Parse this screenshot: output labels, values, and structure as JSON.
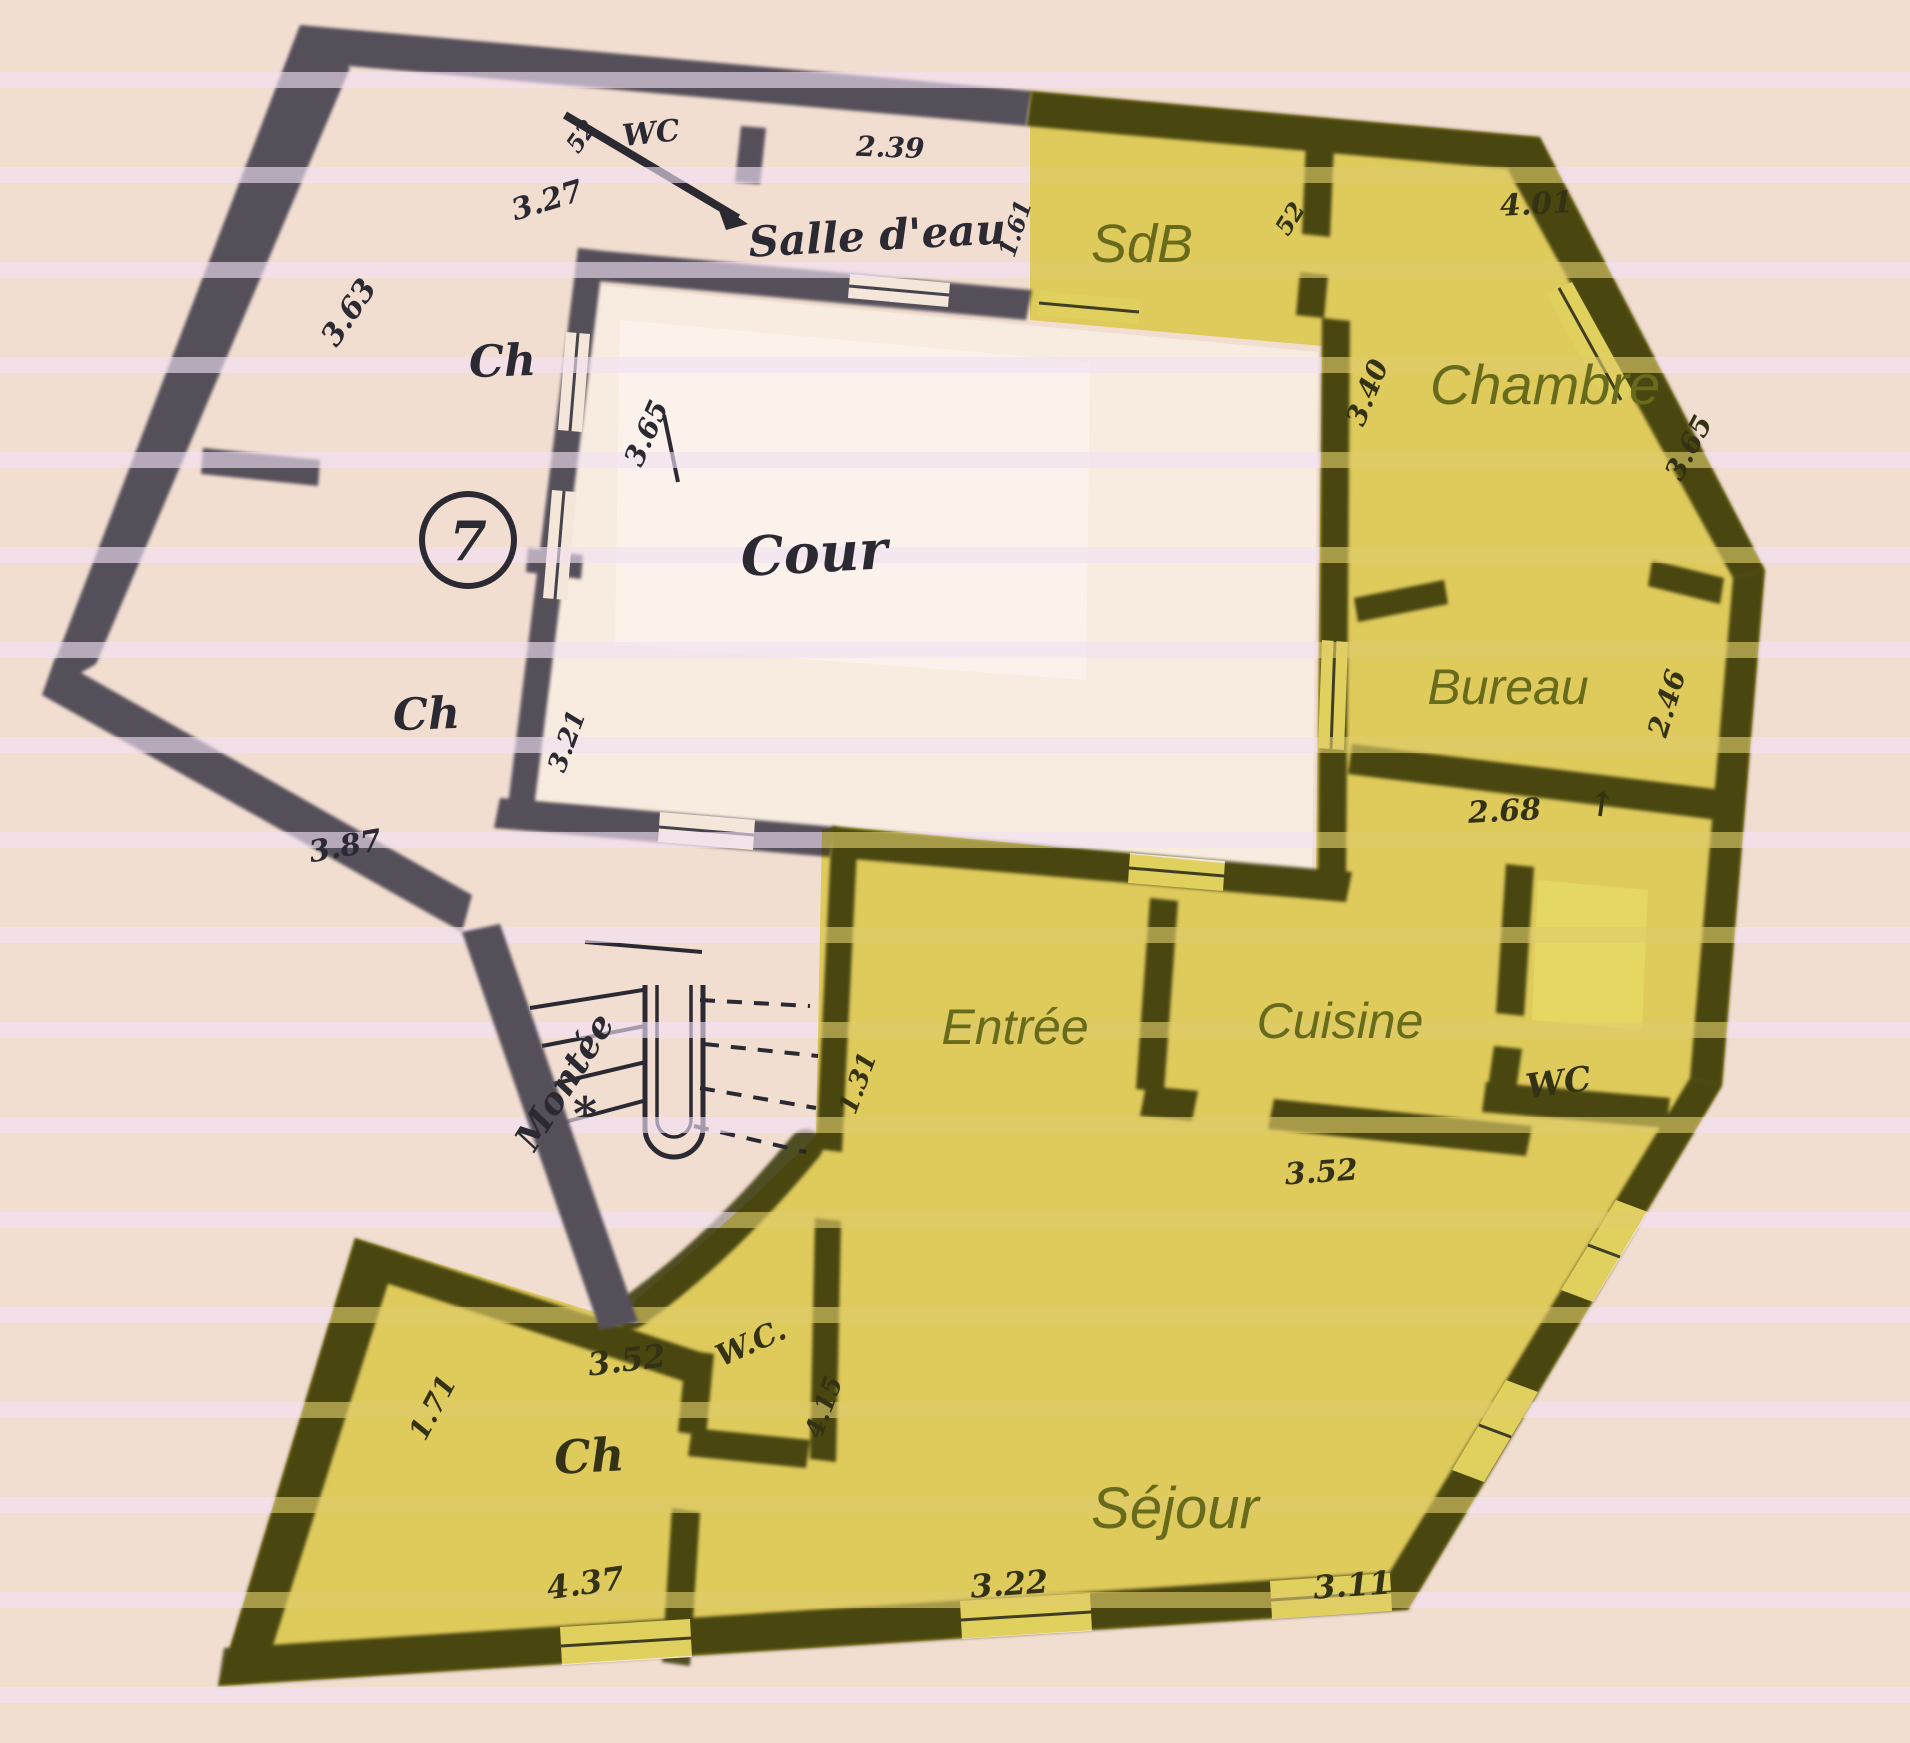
{
  "plan": {
    "apartment_number": "7",
    "rooms": {
      "wc_top": {
        "label": "WC"
      },
      "salle_deau": {
        "label": "Salle d'eau"
      },
      "ch_upper": {
        "label": "Ch"
      },
      "ch_lower": {
        "label": "Ch"
      },
      "cour": {
        "label": "Cour"
      },
      "montee": {
        "label": "Montée"
      },
      "wc_stairs": {
        "label": "W.C."
      },
      "ch_bottom": {
        "label": "Ch"
      },
      "sdb": {
        "label": "SdB"
      },
      "chambre": {
        "label": "Chambre"
      },
      "bureau": {
        "label": "Bureau"
      },
      "entree": {
        "label": "Entrée"
      },
      "cuisine": {
        "label": "Cuisine"
      },
      "wc_right": {
        "label": "WC"
      },
      "sejour": {
        "label": "Séjour"
      }
    },
    "measurements": [
      {
        "id": "len-327",
        "value": "3.27"
      },
      {
        "id": "len-52-wc",
        "value": "52"
      },
      {
        "id": "len-239",
        "value": "2.39"
      },
      {
        "id": "len-161",
        "value": "1.61"
      },
      {
        "id": "len-363",
        "value": "3.63"
      },
      {
        "id": "len-365-cour",
        "value": "3.65"
      },
      {
        "id": "len-321",
        "value": "3.21"
      },
      {
        "id": "len-387",
        "value": "3.87"
      },
      {
        "id": "len-52-sdb",
        "value": "52"
      },
      {
        "id": "len-401",
        "value": "4.01"
      },
      {
        "id": "len-340",
        "value": "3.40"
      },
      {
        "id": "len-365-right",
        "value": "3.65"
      },
      {
        "id": "len-246",
        "value": "2.46"
      },
      {
        "id": "len-268",
        "value": "2.68"
      },
      {
        "id": "len-131",
        "value": "1.31"
      },
      {
        "id": "len-415",
        "value": "4.15"
      },
      {
        "id": "len-352-cuisine",
        "value": "3.52"
      },
      {
        "id": "len-352-ch",
        "value": "3.52"
      },
      {
        "id": "len-171",
        "value": "1.71"
      },
      {
        "id": "len-437",
        "value": "4.37"
      },
      {
        "id": "len-322",
        "value": "3.22"
      },
      {
        "id": "len-311",
        "value": "3.11"
      }
    ],
    "annotations": {
      "direction_arrow": "↑",
      "stairs_mark": "*"
    },
    "colors": {
      "paper": "#f2ded1",
      "highlight_yellow": "#e6e24c",
      "wall_dark": "#54505a",
      "wall_highlighted": "#4f4d20",
      "label_olive": "#676b1b",
      "ink": "#2b2932"
    }
  }
}
